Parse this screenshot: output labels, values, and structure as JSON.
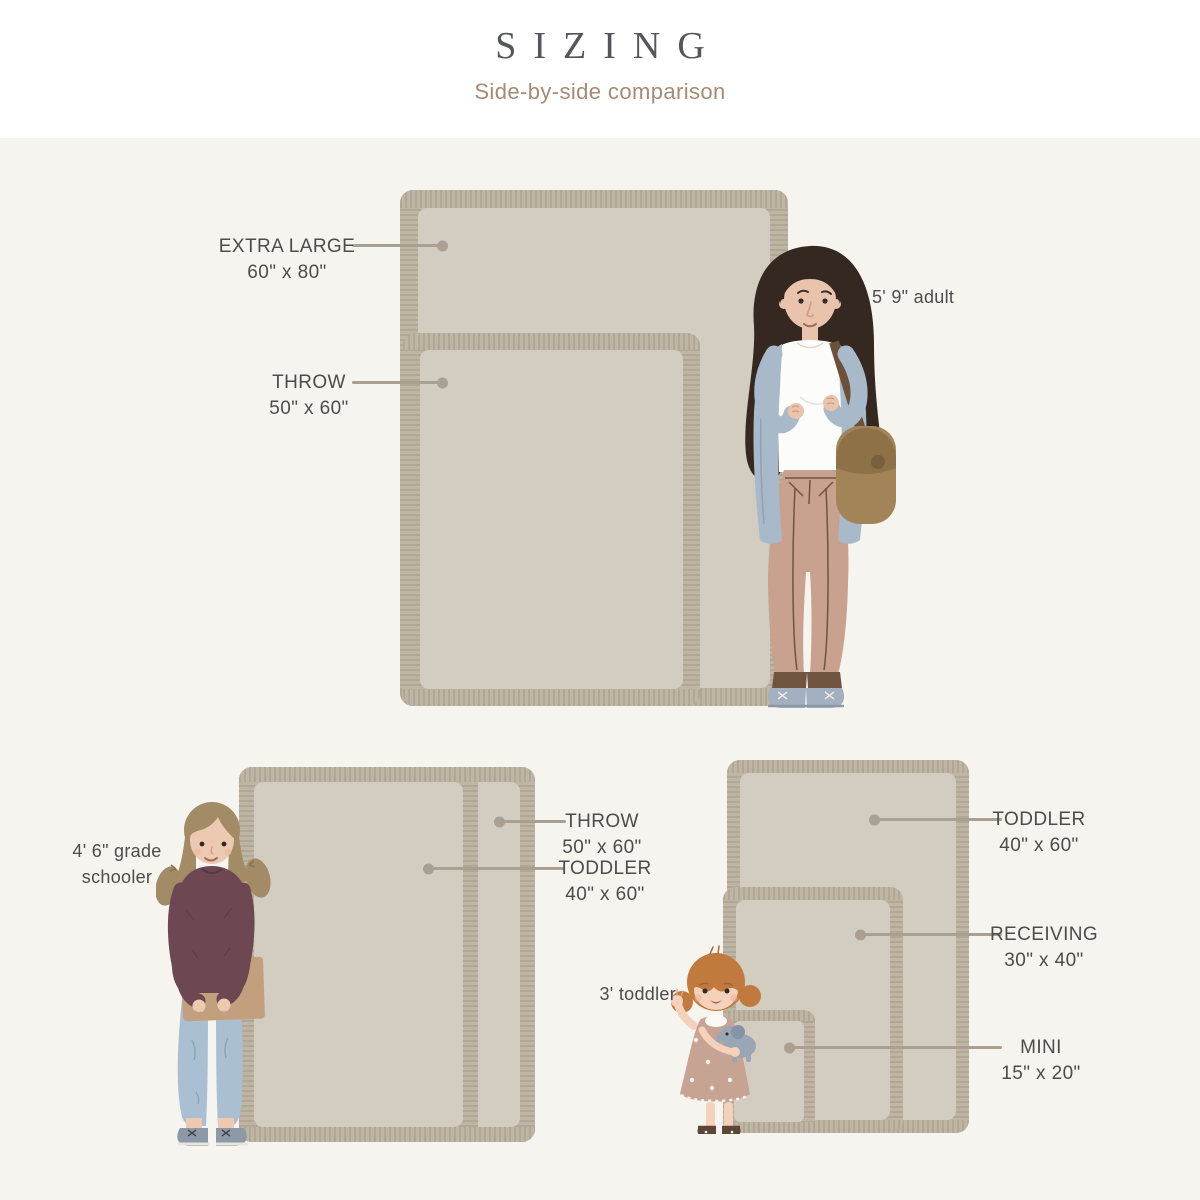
{
  "title": "SIZING",
  "subtitle": "Side-by-side comparison",
  "sections": {
    "top": {
      "person": "5' 9\" adult",
      "blankets": [
        {
          "label": "EXTRA LARGE",
          "size": "60\" x 80\""
        },
        {
          "label": "THROW",
          "size": "50\" x 60\""
        }
      ]
    },
    "bottom_left": {
      "person": "4' 6\" grade schooler",
      "blankets": [
        {
          "label": "THROW",
          "size": "50\" x 60\""
        },
        {
          "label": "TODDLER",
          "size": "40\" x 60\""
        }
      ]
    },
    "bottom_right": {
      "person": "3' toddler",
      "blankets": [
        {
          "label": "TODDLER",
          "size": "40\" x 60\""
        },
        {
          "label": "RECEIVING",
          "size": "30\" x 40\""
        },
        {
          "label": "MINI",
          "size": "15\" x 20\""
        }
      ]
    }
  },
  "colors": {
    "header-bg": "#ffffff",
    "page-bg": "#f5f4ef",
    "title-color": "#55565c",
    "subtitle-color": "#a58b73",
    "label-color": "#4c4c4c",
    "leader-color": "#a9a092",
    "fringe-color": "#b5ab9b",
    "blanket-color": "#d3ccc0"
  }
}
